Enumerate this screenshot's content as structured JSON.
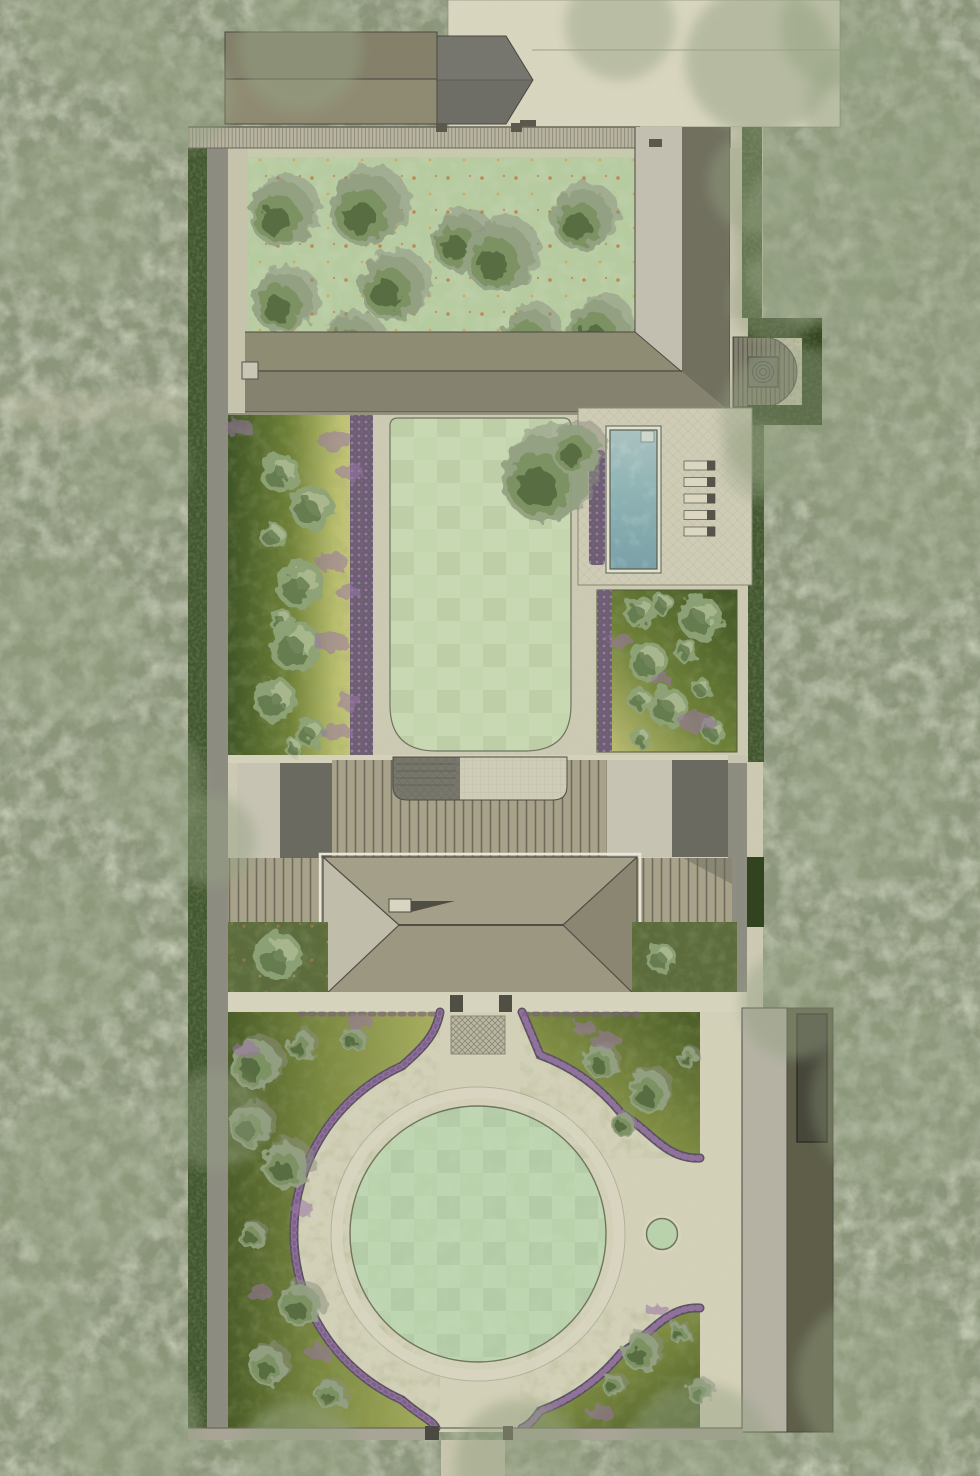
{
  "meta": {
    "type": "landscape-site-plan",
    "width": 980,
    "height": 1476,
    "description": "Top-down rendered garden masterplan: walled plot in woodland with orchard, L-shaped barn, pool terrace, main hip-roof house, circular lawn driveway and garage strip."
  },
  "counts": {
    "orchard_trees": 10,
    "sun_loungers": 5
  },
  "colors": {
    "woodland_base": "#8b9579",
    "woodland_light": "#a9b390",
    "woodland_dark": "#667058",
    "hedge": "#42562f",
    "hedge_dark": "#31441f",
    "boundary_path": "#8d8d82",
    "wall_band": "#b8b4a1",
    "wall_line": "#6b6859",
    "gravel": "#ccc9b2",
    "gravel_light": "#d8d5bf",
    "drive": "#d3d0b8",
    "orchard_lawn": "#b7cba1",
    "lawn": "#c4d6ad",
    "circle_lawn": "#b9d2ab",
    "lawn_edge": "#70755f",
    "tree_outer": "#94a182",
    "tree_mid": "#7a9160",
    "tree_dark": "#4f6539",
    "tree_shadow": "#8b907f",
    "shrub": "#8da277",
    "shrub_light": "#bac79c",
    "barn_roof": "#8f8b72",
    "barn_shade": "#7c7965",
    "gable_roof": "#6e6e66",
    "ridge": "#55524a",
    "lbuild_inner": "#c3bfb0",
    "lbuild_outer": "#8f8c74",
    "lbuild_dark": "#71705f",
    "lbuild_low": "#858370",
    "deck": "#83816f",
    "deck_line": "#5a584d",
    "pool_coping": "#e3e0cd",
    "pool_top": "#a9c2c0",
    "pool_mid": "#8fb3b4",
    "pool_deep": "#7aa1a8",
    "pool_edge": "#55604f",
    "lounger": "#dad6c1",
    "lounger_dark": "#55534a",
    "terrace": "#cfccb6",
    "paver_line": "#b5b19a",
    "bed_dark": "#3f5526",
    "bed_mid": "#6f8138",
    "bed_light": "#b8bd6c",
    "bed_light2": "#c7c57b",
    "lavender_base": "#6b5f70",
    "lavender_dot": "#9a77a6",
    "lavender_dot2": "#7a5e88",
    "veranda": "#a7a289",
    "veranda_line": "#6f6b5c",
    "flat_light": "#c6c3b3",
    "flat_dark": "#6b6a60",
    "court_dark": "#77776c",
    "court_light": "#cecbb6",
    "court_line": "#63635a",
    "hip_top": "#a49f88",
    "hip_left": "#c1bdab",
    "hip_bottom": "#9c9780",
    "hip_right": "#8a8672",
    "roof_edge": "#4f4d44",
    "eave_light": "#e9e6d9",
    "garden_dark": "#5c6c3c",
    "meadow_dark": "#4a5c28",
    "meadow_mid": "#7c8a41",
    "meadow_light": "#aab060",
    "purple_edge": "#5a5361",
    "garage_light": "#b5b2a4",
    "garage_dark": "#5e5e49",
    "garage_door": "#46463a",
    "fruit": "#c08049",
    "fruit2": "#d8a35c",
    "outline": "#4a4a40"
  },
  "pool": {
    "loungers": {
      "x": 684,
      "y0": 461,
      "w": 31,
      "h": 9,
      "gap": 16.5,
      "head_w": 8,
      "count": 5
    }
  },
  "plants": {
    "orchard_trees": [
      [
        281,
        214,
        34
      ],
      [
        366,
        210,
        38
      ],
      [
        283,
        303,
        32
      ],
      [
        392,
        288,
        34
      ],
      [
        350,
        347,
        32
      ],
      [
        460,
        243,
        30
      ],
      [
        499,
        258,
        36
      ],
      [
        582,
        220,
        32
      ],
      [
        529,
        337,
        29
      ],
      [
        598,
        331,
        32
      ]
    ],
    "lawn_trees": [
      [
        545,
        478,
        46
      ],
      [
        576,
        450,
        26
      ]
    ],
    "left_border_shrubs": [
      [
        280,
        473,
        20
      ],
      [
        312,
        508,
        22
      ],
      [
        273,
        536,
        13
      ],
      [
        300,
        585,
        24
      ],
      [
        281,
        620,
        12
      ],
      [
        296,
        647,
        26
      ],
      [
        275,
        700,
        22
      ],
      [
        310,
        733,
        15
      ],
      [
        294,
        748,
        9
      ]
    ],
    "right_bed_shrubs": [
      [
        640,
        612,
        16
      ],
      [
        663,
        604,
        11
      ],
      [
        700,
        618,
        22
      ],
      [
        648,
        662,
        20
      ],
      [
        686,
        650,
        12
      ],
      [
        640,
        700,
        12
      ],
      [
        668,
        707,
        20
      ],
      [
        701,
        688,
        10
      ],
      [
        713,
        731,
        12
      ],
      [
        641,
        738,
        10
      ]
    ],
    "house_garden_shrubs": [
      [
        278,
        956,
        24
      ],
      [
        661,
        958,
        15
      ]
    ],
    "bottom_left_trees": [
      [
        255,
        1065,
        26
      ],
      [
        301,
        1046,
        15
      ],
      [
        250,
        1126,
        22
      ],
      [
        286,
        1166,
        24
      ],
      [
        252,
        1236,
        14
      ],
      [
        300,
        1306,
        22
      ],
      [
        268,
        1366,
        20
      ],
      [
        331,
        1396,
        15
      ],
      [
        353,
        1040,
        13
      ]
    ],
    "bottom_right_trees_upper": [
      [
        601,
        1062,
        17
      ],
      [
        649,
        1092,
        22
      ],
      [
        623,
        1125,
        12
      ],
      [
        688,
        1058,
        11
      ]
    ],
    "bottom_right_trees_lower": [
      [
        641,
        1352,
        20
      ],
      [
        613,
        1385,
        12
      ],
      [
        679,
        1333,
        11
      ],
      [
        700,
        1392,
        13
      ]
    ],
    "purple_patches": [
      [
        336,
        441,
        12
      ],
      [
        350,
        472,
        9
      ],
      [
        332,
        562,
        11
      ],
      [
        347,
        592,
        8
      ],
      [
        331,
        642,
        12
      ],
      [
        349,
        702,
        9
      ],
      [
        336,
        732,
        10
      ],
      [
        239,
        428,
        10
      ],
      [
        620,
        640,
        8
      ],
      [
        696,
        722,
        12
      ],
      [
        662,
        680,
        7
      ],
      [
        606,
        1040,
        10
      ],
      [
        584,
        1028,
        8
      ],
      [
        360,
        1022,
        9
      ],
      [
        302,
        1208,
        8
      ],
      [
        258,
        1292,
        9
      ],
      [
        318,
        1352,
        9
      ],
      [
        246,
        1050,
        9
      ],
      [
        657,
        1310,
        8
      ],
      [
        600,
        1412,
        9
      ]
    ],
    "canopies": [
      [
        300,
        50,
        62,
        0.5
      ],
      [
        180,
        95,
        55,
        0.45
      ],
      [
        95,
        20,
        70,
        0.4
      ],
      [
        620,
        25,
        55,
        0.45
      ],
      [
        760,
        60,
        75,
        0.5
      ],
      [
        890,
        115,
        85,
        0.45
      ],
      [
        840,
        28,
        60,
        0.45
      ],
      [
        940,
        180,
        70,
        0.4
      ],
      [
        930,
        330,
        100,
        0.4
      ],
      [
        820,
        240,
        85,
        0.45
      ],
      [
        795,
        420,
        75,
        0.45
      ],
      [
        905,
        520,
        90,
        0.4
      ],
      [
        762,
        462,
        40,
        0.35
      ],
      [
        760,
        182,
        52,
        0.45
      ],
      [
        775,
        300,
        45,
        0.45
      ],
      [
        70,
        220,
        80,
        0.4
      ],
      [
        130,
        470,
        60,
        0.35
      ],
      [
        58,
        640,
        85,
        0.4
      ],
      [
        150,
        780,
        55,
        0.4
      ],
      [
        60,
        950,
        80,
        0.4
      ],
      [
        210,
        840,
        46,
        0.45
      ],
      [
        215,
        1120,
        50,
        0.4
      ],
      [
        80,
        1180,
        85,
        0.4
      ],
      [
        130,
        1424,
        70,
        0.45
      ],
      [
        300,
        1462,
        62,
        0.5
      ],
      [
        520,
        1464,
        65,
        0.5
      ],
      [
        700,
        1458,
        75,
        0.45
      ],
      [
        880,
        1380,
        85,
        0.4
      ],
      [
        900,
        1100,
        90,
        0.35
      ],
      [
        868,
        800,
        85,
        0.35
      ],
      [
        795,
        1004,
        55,
        0.45
      ],
      [
        30,
        1320,
        60,
        0.35
      ]
    ]
  }
}
